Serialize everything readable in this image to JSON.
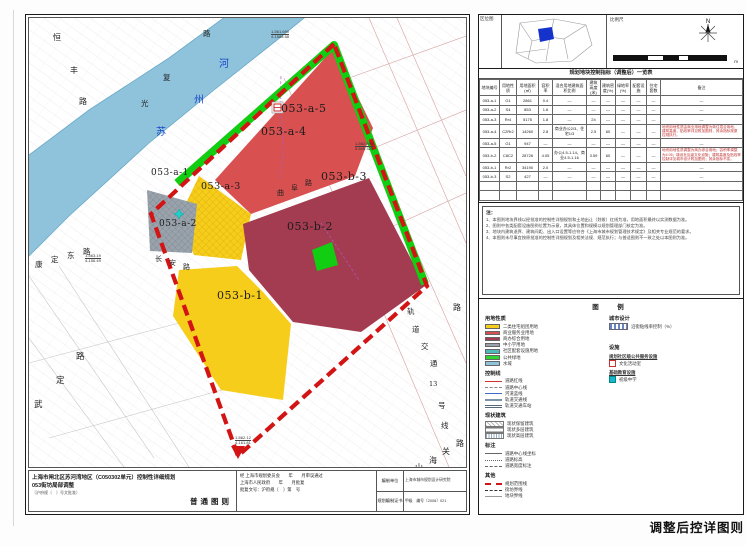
{
  "plate_title": "调整后控详图则",
  "sheet": {
    "map": {
      "zone_labels": [
        {
          "text": "053-a-1",
          "x": 122,
          "y": 150,
          "fs": 9
        },
        {
          "text": "053-a-2",
          "x": 130,
          "y": 201,
          "fs": 9
        },
        {
          "text": "053-a-3",
          "x": 172,
          "y": 163,
          "fs": 9.5
        },
        {
          "text": "053-a-4",
          "x": 232,
          "y": 107,
          "fs": 11
        },
        {
          "text": "053-a-5",
          "x": 252,
          "y": 84,
          "fs": 11
        },
        {
          "text": "053-b-1",
          "x": 188,
          "y": 271,
          "fs": 11
        },
        {
          "text": "053-b-2",
          "x": 258,
          "y": 202,
          "fs": 11
        },
        {
          "text": "053-b-3",
          "x": 292,
          "y": 152,
          "fs": 11
        }
      ],
      "road_chars": [
        {
          "t": "恒",
          "x": 24,
          "y": 14,
          "c": "#222",
          "fs": 8
        },
        {
          "t": "丰",
          "x": 41,
          "y": 47,
          "c": "#222",
          "fs": 8
        },
        {
          "t": "路",
          "x": 50,
          "y": 78,
          "c": "#222",
          "fs": 8
        },
        {
          "t": "光",
          "x": 112,
          "y": 80,
          "c": "#222",
          "fs": 7.5
        },
        {
          "t": "复",
          "x": 134,
          "y": 54,
          "c": "#222",
          "fs": 7.5
        },
        {
          "t": "路",
          "x": 174,
          "y": 10,
          "c": "#222",
          "fs": 7.5
        },
        {
          "t": "苏",
          "x": 127,
          "y": 105,
          "c": "#1848c8",
          "fs": 10
        },
        {
          "t": "州",
          "x": 165,
          "y": 73,
          "c": "#1848c8",
          "fs": 10
        },
        {
          "t": "河",
          "x": 190,
          "y": 37,
          "c": "#1848c8",
          "fs": 10
        },
        {
          "t": "康",
          "x": 6,
          "y": 241,
          "c": "#222",
          "fs": 7.5
        },
        {
          "t": "定",
          "x": 22,
          "y": 236,
          "c": "#222",
          "fs": 7.5
        },
        {
          "t": "东",
          "x": 38,
          "y": 232,
          "c": "#222",
          "fs": 7.5
        },
        {
          "t": "路",
          "x": 54,
          "y": 228,
          "c": "#222",
          "fs": 7.5
        },
        {
          "t": "武",
          "x": 5,
          "y": 380,
          "c": "#222",
          "fs": 8.5
        },
        {
          "t": "定",
          "x": 27,
          "y": 356,
          "c": "#222",
          "fs": 8.5
        },
        {
          "t": "路",
          "x": 47,
          "y": 332,
          "c": "#222",
          "fs": 8.5
        },
        {
          "t": "曲",
          "x": 248,
          "y": 170,
          "c": "#222",
          "fs": 7
        },
        {
          "t": "阜",
          "x": 262,
          "y": 165,
          "c": "#222",
          "fs": 7
        },
        {
          "t": "路",
          "x": 276,
          "y": 160,
          "c": "#222",
          "fs": 7
        },
        {
          "t": "长",
          "x": 126,
          "y": 236,
          "c": "#222",
          "fs": 7
        },
        {
          "t": "安",
          "x": 140,
          "y": 240,
          "c": "#222",
          "fs": 7
        },
        {
          "t": "路",
          "x": 154,
          "y": 244,
          "c": "#222",
          "fs": 7
        },
        {
          "t": "轨",
          "x": 378,
          "y": 288,
          "c": "#222",
          "fs": 7.5
        },
        {
          "t": "道",
          "x": 383,
          "y": 306,
          "c": "#222",
          "fs": 7.5
        },
        {
          "t": "交",
          "x": 392,
          "y": 323,
          "c": "#222",
          "fs": 7.5
        },
        {
          "t": "通",
          "x": 401,
          "y": 340,
          "c": "#222",
          "fs": 7.5
        },
        {
          "t": "13",
          "x": 400,
          "y": 362,
          "c": "#222",
          "fs": 6.5
        },
        {
          "t": "号",
          "x": 409,
          "y": 382,
          "c": "#222",
          "fs": 7.5
        },
        {
          "t": "线",
          "x": 412,
          "y": 402,
          "c": "#222",
          "fs": 7.5
        },
        {
          "t": "路",
          "x": 424,
          "y": 284,
          "c": "#222",
          "fs": 8
        },
        {
          "t": "山",
          "x": 386,
          "y": 444,
          "c": "#222",
          "fs": 8
        },
        {
          "t": "海",
          "x": 400,
          "y": 437,
          "c": "#222",
          "fs": 8
        },
        {
          "t": "关",
          "x": 413,
          "y": 428,
          "c": "#222",
          "fs": 8
        },
        {
          "t": "路",
          "x": 427,
          "y": 420,
          "c": "#222",
          "fs": 8
        }
      ],
      "coord_labels": [
        {
          "l1": "1-561.690",
          "l2": "4-1588.58",
          "x": 242,
          "y": 12
        },
        {
          "l1": "1-562.890",
          "l2": "5-806.325",
          "x": 326,
          "y": 124
        },
        {
          "l1": "1-563.19",
          "l2": "4-156.49",
          "x": 56,
          "y": 236
        },
        {
          "l1": "1-562.12",
          "l2": "4-161.81",
          "x": 206,
          "y": 418
        }
      ]
    },
    "footer": {
      "title_line1": "上海市闸北区苏河湾地区（C050302单元）控制性详细规划",
      "title_line2": "053街坊局部调整",
      "title_line3": "（沪府规〔　〕号文批准）",
      "sheet_type": "普通图则",
      "approval_line1": "经 上海市规划委员会　　年　　月审议通过",
      "approval_line2": "上海市人民政府　　年　　月批复",
      "approval_line3": "批复文号：沪府规〔　〕第　号",
      "org_rows": [
        {
          "label": "编制单位",
          "value": "上海市城市规划设计研究院"
        },
        {
          "label": "规划编制证书",
          "value": "甲级　编号〔2008〕021"
        }
      ]
    }
  },
  "panel": {
    "location": {
      "corner_label": "区位图",
      "scale_label": "比例尺",
      "north_label": "N",
      "scale_unit": "m"
    },
    "table": {
      "title": "规划地块控制指标（调整后）一览表",
      "headers": [
        "地块编号",
        "用地性质",
        "用地面积(㎡)",
        "容积率",
        "混合用地建筑面积比例",
        "建筑高度(米)",
        "建筑密度(%)",
        "绿地率(%)",
        "配套设施",
        "住宅套数",
        "备注"
      ],
      "rows": [
        {
          "hot": false,
          "cells": [
            "053-a-1",
            "G1",
            "2861",
            "0.4",
            "—",
            "—",
            "—",
            "—",
            "—",
            "—",
            "—"
          ]
        },
        {
          "hot": false,
          "cells": [
            "053-a-2",
            "S4",
            "853",
            "1.6",
            "—",
            "—",
            "—",
            "—",
            "—",
            "—",
            "—"
          ]
        },
        {
          "hot": false,
          "cells": [
            "053-a-3",
            "Rr4",
            "5175",
            "1.8",
            "—",
            "24",
            "—",
            "—",
            "—",
            "—",
            "—"
          ]
        },
        {
          "hot": true,
          "cells": [
            "053-a-4",
            "C2Rr2",
            "14260",
            "2.8",
            "商业办公2/3、住宅1/3",
            "2.5",
            "60",
            "—",
            "—",
            "—",
            "地块用地性质由商业用地调整为商住混合用地，建筑高度、贴线率详见附加图则，其余指标按原控规执行。"
          ]
        },
        {
          "hot": false,
          "cells": [
            "053-a-5",
            "G1",
            "947",
            "—",
            "—",
            "—",
            "—",
            "—",
            "—",
            "—",
            "—"
          ]
        },
        {
          "hot": true,
          "cells": [
            "053-b-2",
            "C8C2",
            "28726",
            "4.05",
            "办公4.5-1.14、商业4.5-1.16",
            "3.59",
            "60",
            "—",
            "—",
            "—",
            "地块用地性质调整为商办综合用地；容积率调整为4.05；增设社区级文化设施；建筑高度及贴线率控制详见城市设计附加图则；其余指标不变。"
          ]
        },
        {
          "hot": false,
          "cells": [
            "053-b-1",
            "Rr2",
            "34190",
            "2.0",
            "—",
            "—",
            "—",
            "—",
            "—",
            "—",
            "—"
          ]
        },
        {
          "hot": false,
          "cells": [
            "053-b-3",
            "S2",
            "427",
            "—",
            "—",
            "—",
            "—",
            "—",
            "—",
            "—",
            "—"
          ]
        },
        {
          "hot": false,
          "cells": [
            "",
            "",
            "",
            "",
            "",
            "",
            "",
            "",
            "",
            "",
            ""
          ]
        },
        {
          "hot": false,
          "cells": [
            "",
            "",
            "",
            "",
            "",
            "",
            "",
            "",
            "",
            "",
            ""
          ]
        }
      ]
    },
    "notes": {
      "title": "注：",
      "items": [
        "1、本图则地块界线以经批准的控制性详细规划和土地出让（划拨）红线为准，用地面积最终以实测数据为准。",
        "2、图则中各类配套设施图例位置为示意，其具体位置和规模以规划管理部门核定为准。",
        "3、地块内建筑退界、建筑间距、出入口设置等应符合《上海市城市规划管理技术规定》及相关专业规范的要求。",
        "4、本图则未尽事宜按原批准的控制性详细规划及相关法规、规范执行；与普适图则不一致之处以本图则为准。"
      ]
    },
    "legend": {
      "title": "图　例",
      "landuse": {
        "title": "用地性质",
        "items": [
          {
            "c": "#F6CD1B",
            "l": "二类住宅组团用地"
          },
          {
            "c": "#D85050",
            "l": "商业服务业用地"
          },
          {
            "c": "#A33C50",
            "l": "商办综合用地"
          },
          {
            "c": "#9AA3AC",
            "l": "中小学用地"
          },
          {
            "c": "#4FB8B8",
            "l": "社区配套设施用地"
          },
          {
            "c": "#2ED52E",
            "l": "公共绿地"
          },
          {
            "c": "#8FC3DC",
            "l": "水域"
          }
        ]
      },
      "lines": {
        "title": "控制线",
        "items": [
          {
            "cls": "ln-red",
            "l": "道路红线"
          },
          {
            "cls": "ln-center",
            "l": "道路中心线"
          },
          {
            "cls": "ln-blue",
            "l": "河道蓝线"
          },
          {
            "cls": "ln-rail",
            "l": "轨道交通线"
          },
          {
            "cls": "ln-railst",
            "l": "轨道交通车站"
          }
        ]
      },
      "status": {
        "title": "现状建筑",
        "items": [
          {
            "cls": "st-1",
            "l": "现状保留建筑"
          },
          {
            "cls": "st-2",
            "l": "现状多层建筑"
          },
          {
            "cls": "st-3",
            "l": "现状高层建筑"
          }
        ]
      },
      "marks": {
        "title": "标注",
        "items": [
          {
            "cls": "mk-1",
            "l": "道路中心线坐标"
          },
          {
            "cls": "mk-2",
            "l": "道路标高"
          },
          {
            "cls": "mk-3",
            "l": "道路宽度标注"
          }
        ]
      },
      "other": {
        "title": "其他",
        "items": [
          {
            "cls": "ot-1",
            "l": "规划范围线"
          },
          {
            "cls": "ot-2",
            "l": "街坊界线"
          },
          {
            "cls": "ot-3",
            "l": "地块界线"
          }
        ]
      },
      "design": {
        "title": "城市设计",
        "swatch_label": "沿街贴线率控制（%）"
      },
      "facility": {
        "title": "设施",
        "group1": "规划社区级公共服务设施",
        "item1": "文化活动室",
        "group2": "基础教育设施",
        "item2": "初级中学"
      }
    }
  }
}
